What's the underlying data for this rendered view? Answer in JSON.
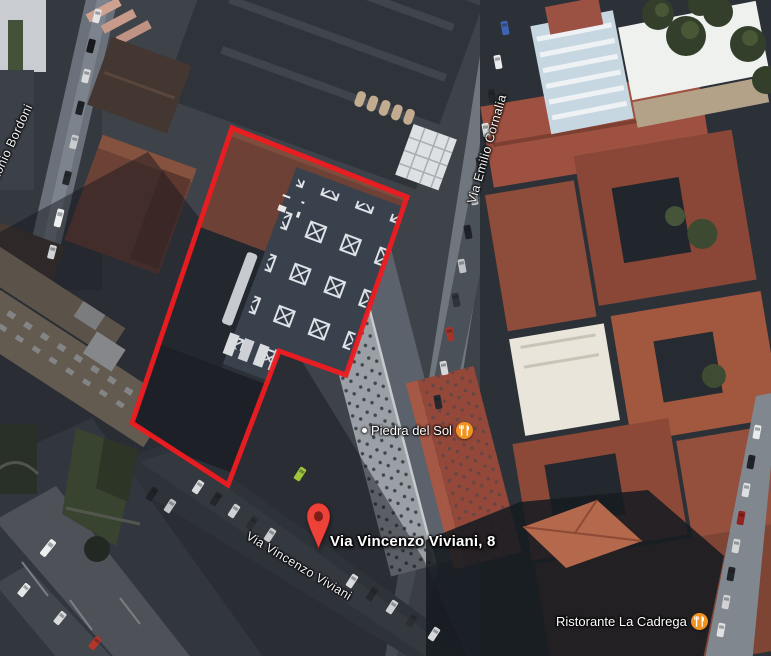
{
  "map": {
    "view": "satellite",
    "outline": {
      "points": "232,128 407,197 346,375 279,351 228,485 132,423",
      "color": "#ed1c20"
    },
    "marker": {
      "address": "Via Vincenzo Viviani, 8",
      "color": "#ee4239",
      "hole_color": "#7c1f19"
    },
    "streets": [
      {
        "id": "antonio-bordoni",
        "name": "Antonio Bordoni"
      },
      {
        "id": "via-emilio-cornalia",
        "name": "Via Emilio Cornalia"
      },
      {
        "id": "via-vincenzo-viviani",
        "name": "Via Vincenzo Viviani"
      }
    ],
    "pois": [
      {
        "id": "piedra-del-sol",
        "name": "Piedra del Sol",
        "icon": "restaurant-icon",
        "icon_color": "#f09320"
      },
      {
        "id": "ristorante-la-cadrega",
        "name": "Ristorante La Cadrega",
        "icon": "restaurant-icon",
        "icon_color": "#f09320"
      }
    ]
  }
}
